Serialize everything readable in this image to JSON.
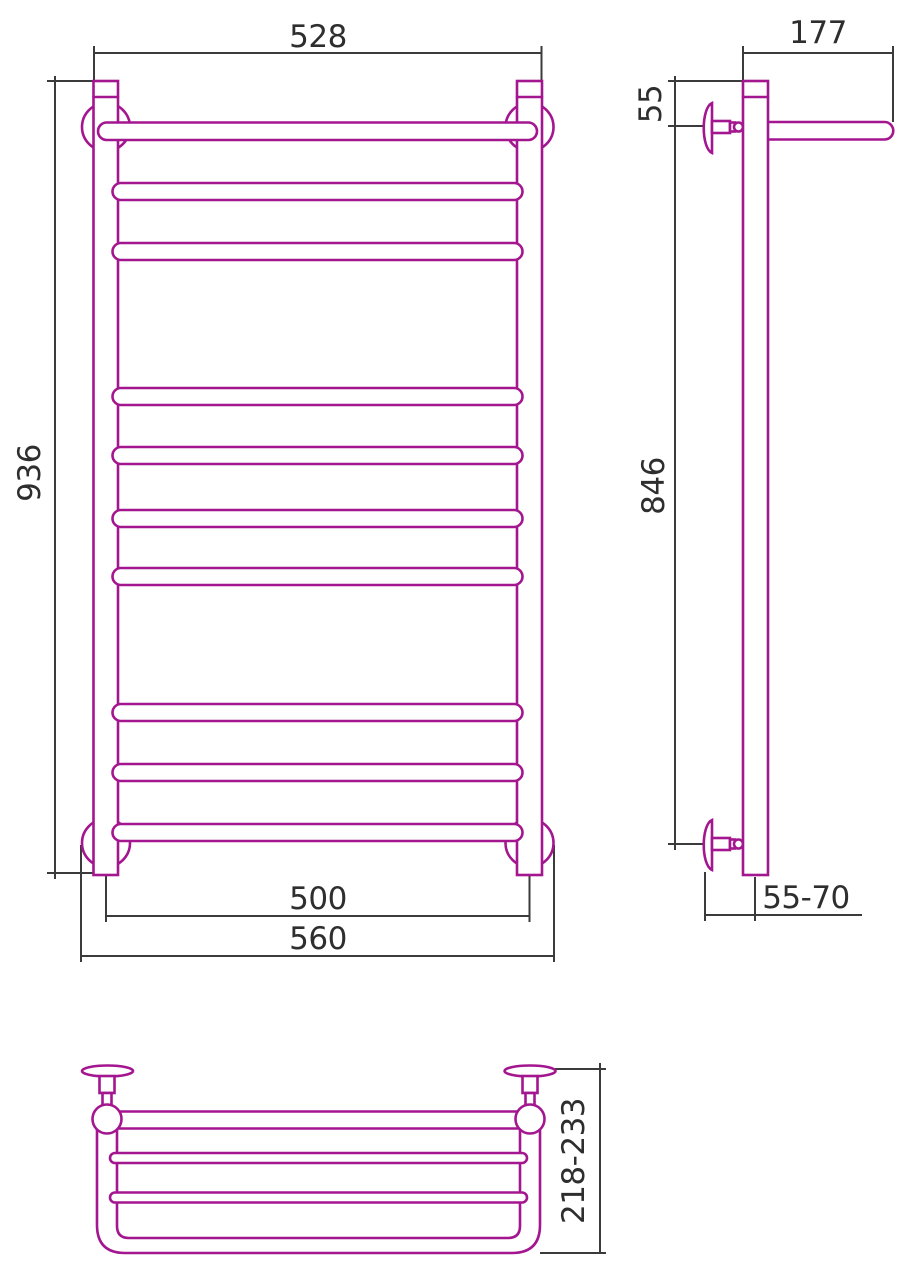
{
  "drawing": {
    "kind": "technical-dimension-drawing",
    "subject": "ladder-towel-rail-with-top-shelf",
    "colors": {
      "product_outline": "#A4168F",
      "dimension_lines": "#3B3B3B",
      "label_text": "#2E2E2E",
      "background": "#FFFFFF"
    },
    "views": {
      "front": {
        "name": "front-view",
        "dims": {
          "top_width": "528",
          "height": "936",
          "axis_width": "500",
          "overall_width": "560"
        }
      },
      "side": {
        "name": "side-view",
        "dims": {
          "shelf_depth": "177",
          "top_offset": "55",
          "mount_height": "846",
          "wall_distance": "55-70"
        }
      },
      "top": {
        "name": "top-view",
        "dims": {
          "shelf_total_depth": "218-233"
        }
      }
    }
  }
}
